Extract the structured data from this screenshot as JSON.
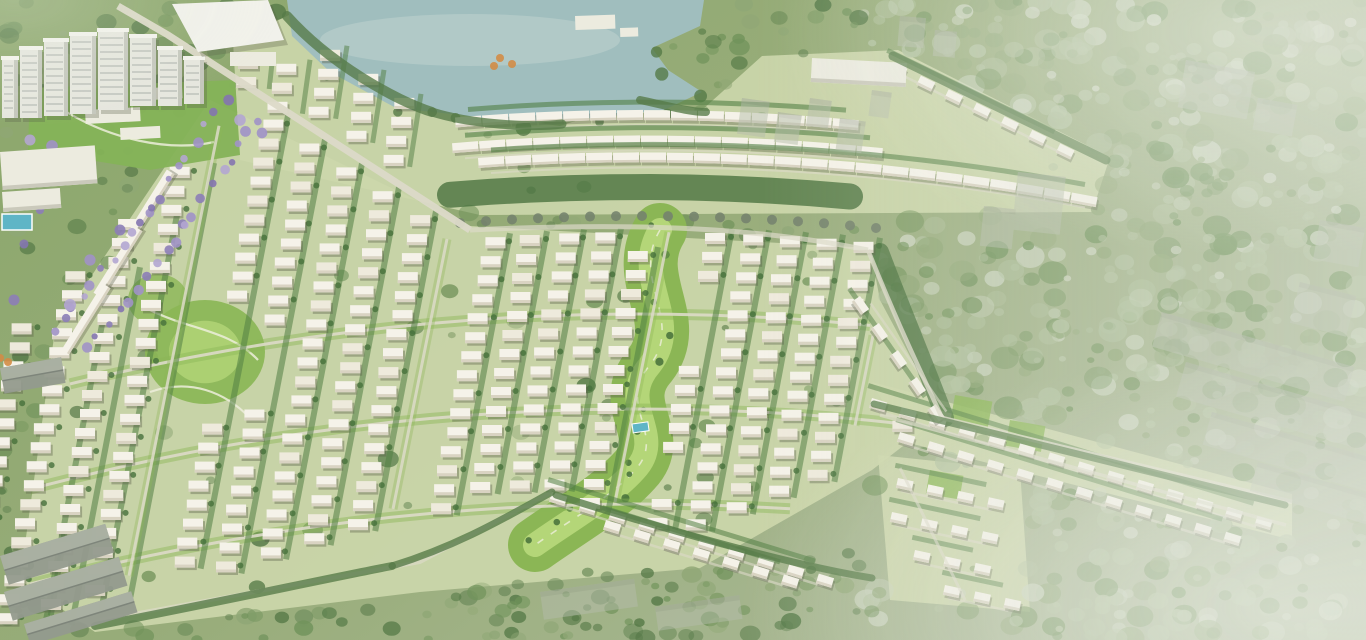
{
  "scene": {
    "label": "township-masterplan-aerial-rendering",
    "canvas": {
      "w": 1366,
      "h": 640
    },
    "palette": {
      "base_l": "#87a466",
      "base_m": "#93a974",
      "base_r": "#a8b694",
      "estate_base": "#cbd6a9",
      "forest_dark": "#4e7440",
      "forest_mid": "#6b8f55",
      "forest_light": "#8ba471",
      "forest_pale": "#aebf9b",
      "haze_blob": "#c9d3bd",
      "lake": "#9cbcbd",
      "lake_light": "#c0d4d2",
      "villa_roof": "#f6f3ea",
      "villa_tint": "#efeadd",
      "villa_wall": "#d8d2c1",
      "villa_shadow": "#50553f",
      "hedge": "#4a7a3c",
      "bush": "#3d6a33",
      "band_dark": "#3f6a35",
      "band_tree": "#6f7d68",
      "park": "#86b44f",
      "park_inner": "#b7d877",
      "park_path": "#edefdc",
      "road": "#dcd9c8",
      "purple": [
        "#9c8ec7",
        "#8779b6",
        "#b0a3d2",
        "#7e6fae"
      ],
      "tower_face": "#e6e7df",
      "tower_side": "#c3c6bc",
      "tower_roof": "#f4f4ee",
      "window": "#a6aca6",
      "ghost_fill": "#b3baa9",
      "ghost_top": "#a2a89a",
      "shed_fill": "#8f968a",
      "shed_ridge": "#798076",
      "shed_light": "#a9afa2",
      "pool": "#58b3c6",
      "orange": "#d2873e",
      "white_bld": "#ecebe0"
    },
    "grid": {
      "curvature": 0.000215,
      "curve_center": 640,
      "col_x0": 40,
      "col_step": 37,
      "col_count": 25,
      "house_pitch": 19,
      "house_w": 20,
      "house_h": 11,
      "lean": 0.2,
      "avenue_every": 6,
      "top_a": 222,
      "bands": [
        317,
        412,
        507
      ]
    },
    "forest": {
      "seed": 11,
      "blobs": 2300
    },
    "masks": {
      "lake": [
        [
          287,
          0
        ],
        [
          704,
          0
        ],
        [
          700,
          26
        ],
        [
          652,
          48
        ],
        [
          668,
          70
        ],
        [
          702,
          92
        ],
        [
          664,
          110
        ],
        [
          596,
          118
        ],
        [
          520,
          124
        ],
        [
          452,
          114
        ],
        [
          396,
          108
        ],
        [
          330,
          72
        ],
        [
          292,
          36
        ]
      ],
      "north": [
        [
          233,
          42
        ],
        [
          289,
          15
        ],
        [
          345,
          45
        ],
        [
          432,
          108
        ],
        [
          560,
          126
        ],
        [
          645,
          98
        ],
        [
          702,
          110
        ],
        [
          762,
          56
        ],
        [
          898,
          50
        ],
        [
          1110,
          157
        ],
        [
          1092,
          212
        ],
        [
          480,
          215
        ],
        [
          240,
          160
        ]
      ],
      "main": [
        [
          210,
          100
        ],
        [
          55,
          330
        ],
        [
          20,
          580
        ],
        [
          95,
          632
        ],
        [
          420,
          592
        ],
        [
          700,
          568
        ],
        [
          872,
          470
        ],
        [
          942,
          416
        ],
        [
          880,
          300
        ],
        [
          870,
          248
        ],
        [
          470,
          226
        ]
      ],
      "arm": [
        [
          872,
          382
        ],
        [
          1292,
          494
        ],
        [
          1292,
          540
        ],
        [
          905,
          442
        ]
      ],
      "se": [
        [
          878,
          455
        ],
        [
          1020,
          470
        ],
        [
          1030,
          612
        ],
        [
          890,
          600
        ]
      ]
    },
    "lake_detail": {
      "highlight": [
        470,
        40,
        150,
        26
      ],
      "huts": [
        [
          575,
          16,
          40,
          14,
          -2
        ],
        [
          620,
          28,
          18,
          9,
          -2
        ]
      ]
    },
    "north_rows": [
      [
        455,
        835,
        110.1
      ],
      [
        452,
        865,
        135.6
      ],
      [
        478,
        1090,
        152.4
      ]
    ],
    "nw_wedge": {
      "x0": 210,
      "x1": 430,
      "step": 37
    },
    "chains": [
      [
        893,
        62,
        7,
        31,
        26
      ],
      [
        872,
        398,
        14,
        31,
        17
      ],
      [
        900,
        432,
        12,
        31,
        17
      ],
      [
        860,
        296,
        5,
        33,
        55
      ],
      [
        552,
        492,
        10,
        31,
        17
      ],
      [
        606,
        520,
        7,
        31,
        17
      ],
      [
        898,
        478,
        4,
        31,
        12
      ],
      [
        892,
        512,
        4,
        31,
        12
      ],
      [
        915,
        550,
        3,
        31,
        12
      ],
      [
        945,
        585,
        3,
        31,
        12
      ]
    ],
    "west_strips": [
      [
        150,
        205
      ],
      [
        118,
        262
      ],
      [
        86,
        319
      ]
    ],
    "spine": {
      "road": "M118,6 L168,35 L470,230",
      "cont": "M470,230 C640,222 760,228 868,250"
    },
    "buffer": {
      "mid_a": 187,
      "x0": 450,
      "x1": 880,
      "tail": "M880,252 C900,305 925,365 945,418"
    },
    "roads": [
      [
        "M868,250 C900,330 925,380 942,418 L1292,502",
        4.5,
        0.8
      ],
      [
        "M100,620 L420,562 L552,492",
        4,
        0.7
      ],
      [
        "M880,415 L1286,525",
        3.5,
        0.7
      ],
      [
        "M900,468 L965,600",
        3,
        0.6
      ]
    ],
    "parks": {
      "central": {
        "d": "M660,230 C630,280 685,320 650,365 C615,405 668,435 635,470 C610,498 570,520 535,545",
        "width": 54
      },
      "left": {
        "cx": 205,
        "cy": 352,
        "rx": 60,
        "ry": 52
      },
      "left2": {
        "cx": 158,
        "cy": 300,
        "rx": 30,
        "ry": 26
      },
      "club": [
        [
          30,
          88
        ],
        [
          235,
          80
        ],
        [
          240,
          155
        ],
        [
          150,
          170
        ],
        [
          28,
          150
        ]
      ],
      "pavilions": [
        [
          150,
          88,
          32,
          12
        ],
        [
          85,
          110,
          55,
          14
        ],
        [
          120,
          128,
          40,
          12
        ]
      ],
      "pool": [
        632,
        424,
        16,
        9,
        -8
      ],
      "paths": [
        "M150,310 C190,330 230,330 258,360",
        "M150,392 C190,378 225,392 250,418",
        "M60,108 C110,140 170,152 214,142"
      ],
      "se_lawns": [
        [
          955,
          395,
          38,
          28
        ],
        [
          1010,
          420,
          36,
          26
        ],
        [
          930,
          470,
          34,
          24
        ]
      ]
    },
    "purple": {
      "p1": [
        [
          225,
          100
        ],
        [
          150,
          210
        ],
        [
          55,
          330
        ]
      ],
      "p2": [
        [
          258,
          118
        ],
        [
          185,
          228
        ],
        [
          88,
          348
        ]
      ],
      "clumps": [
        [
          196,
          86
        ],
        [
          240,
          120
        ],
        [
          262,
          133
        ],
        [
          60,
          180
        ],
        [
          40,
          210
        ],
        [
          24,
          244
        ],
        [
          90,
          260
        ],
        [
          120,
          230
        ],
        [
          30,
          140
        ],
        [
          52,
          146
        ],
        [
          14,
          300
        ],
        [
          70,
          305
        ]
      ]
    },
    "towers": [
      [
        2,
        58,
        16,
        60
      ],
      [
        20,
        48,
        22,
        70
      ],
      [
        44,
        40,
        24,
        76
      ],
      [
        70,
        34,
        26,
        80
      ],
      [
        98,
        30,
        30,
        80
      ],
      [
        130,
        36,
        26,
        70
      ],
      [
        158,
        48,
        24,
        58
      ],
      [
        184,
        58,
        20,
        46
      ]
    ],
    "mall": {
      "roof": [
        [
          172,
          4
        ],
        [
          268,
          0
        ],
        [
          284,
          40
        ],
        [
          198,
          52
        ]
      ],
      "annex": [
        230,
        52,
        46,
        14
      ]
    },
    "flat_buildings": [
      [
        0,
        152,
        95,
        38,
        -4
      ],
      [
        2,
        192,
        58,
        20,
        -4
      ],
      [
        812,
        58,
        95,
        24,
        3
      ]
    ],
    "pool_left": [
      2,
      214,
      30,
      16
    ],
    "orange_trees": [
      [
        500,
        58
      ],
      [
        512,
        64
      ],
      [
        494,
        66
      ],
      [
        0,
        358
      ],
      [
        8,
        362
      ]
    ],
    "tree_lines": [
      [
        "M287,16 C330,64 395,100 432,112",
        10
      ],
      [
        "M432,112 C470,124 530,128 562,124",
        9
      ],
      [
        "M640,100 C668,106 690,112 706,112",
        8
      ],
      [
        "M893,56 L1106,160",
        9
      ],
      [
        "M874,404 L1285,505",
        7
      ],
      [
        "M95,626 C200,606 330,578 392,566",
        8
      ],
      [
        "M392,566 C460,545 510,515 552,492",
        7
      ],
      [
        "M556,495 C660,528 790,565 872,578",
        7
      ]
    ],
    "ghosts": [
      [
        742,
        98,
        28,
        36,
        8
      ],
      [
        778,
        112,
        24,
        30,
        8
      ],
      [
        810,
        98,
        22,
        28,
        8
      ],
      [
        840,
        118,
        26,
        32,
        8
      ],
      [
        872,
        90,
        20,
        26,
        8
      ],
      [
        900,
        16,
        26,
        30,
        5
      ],
      [
        935,
        30,
        22,
        26,
        5
      ],
      [
        1186,
        60,
        70,
        48,
        10
      ],
      [
        1258,
        98,
        40,
        32,
        10
      ],
      [
        1320,
        220,
        46,
        40,
        10
      ],
      [
        1018,
        172,
        48,
        58,
        6
      ],
      [
        984,
        206,
        32,
        40,
        6
      ],
      [
        1300,
        282,
        58,
        42,
        14
      ],
      [
        1162,
        312,
        200,
        36,
        16
      ],
      [
        1186,
        362,
        200,
        36,
        16
      ],
      [
        1212,
        412,
        195,
        34,
        16
      ],
      [
        1258,
        462,
        130,
        30,
        16
      ],
      [
        540,
        592,
        95,
        28,
        -8
      ],
      [
        655,
        607,
        85,
        24,
        -8
      ]
    ],
    "sheds": [
      [
        0,
        556,
        110,
        30,
        -17
      ],
      [
        4,
        592,
        120,
        30,
        -17
      ],
      [
        24,
        624,
        112,
        22,
        -17
      ],
      [
        0,
        368,
        62,
        26,
        -10
      ]
    ]
  }
}
